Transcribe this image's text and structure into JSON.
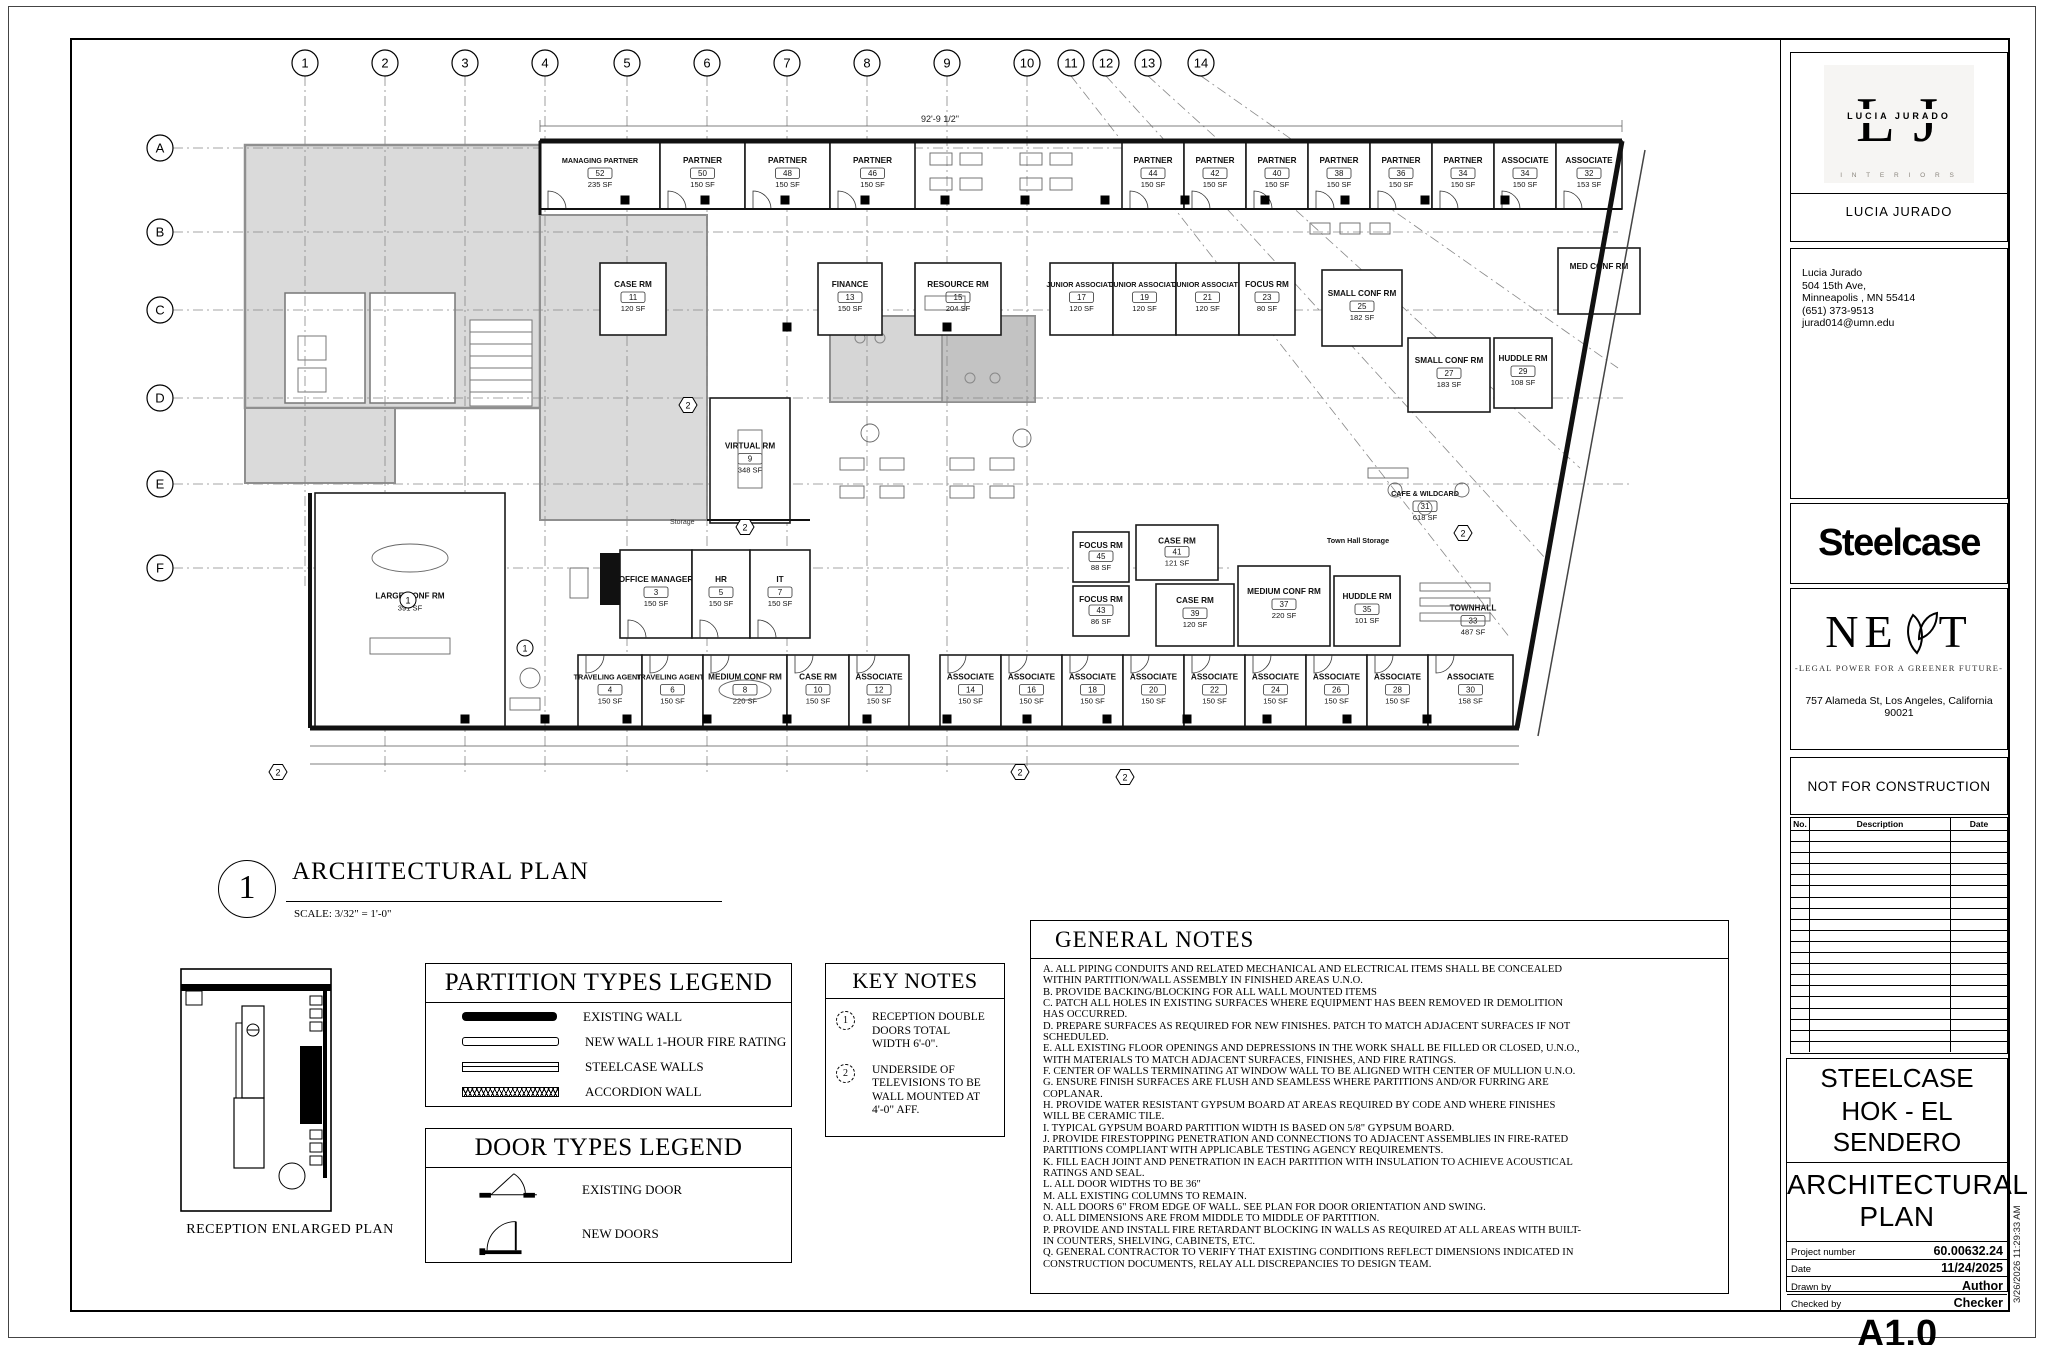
{
  "sheet": {
    "view": {
      "number": "1",
      "title": "ARCHITECTURAL PLAN",
      "scale": "SCALE: 3/32\" = 1'-0\""
    },
    "reception_plan_label": "RECEPTION ENLARGED PLAN",
    "top_dimension": "92'-9 1/2\"",
    "storage_label": "Storage",
    "print_timestamp": "3/26/2026 11:29:33 AM"
  },
  "grid": {
    "columns": [
      {
        "label": "1",
        "x": 235,
        "len": 552
      },
      {
        "label": "2",
        "x": 315,
        "len": 735
      },
      {
        "label": "3",
        "x": 395,
        "len": 735
      },
      {
        "label": "4",
        "x": 475,
        "len": 735
      },
      {
        "label": "5",
        "x": 557,
        "len": 735
      },
      {
        "label": "6",
        "x": 637,
        "len": 735
      },
      {
        "label": "7",
        "x": 717,
        "len": 735
      },
      {
        "label": "8",
        "x": 797,
        "len": 735
      },
      {
        "label": "9",
        "x": 877,
        "len": 735
      },
      {
        "label": "10",
        "x": 957,
        "len": 735
      },
      {
        "label": "11",
        "x": 1001,
        "x2": 1440,
        "y2": 600
      },
      {
        "label": "12",
        "x": 1036,
        "x2": 1475,
        "y2": 520
      },
      {
        "label": "13",
        "x": 1078,
        "x2": 1510,
        "y2": 430
      },
      {
        "label": "14",
        "x": 1131,
        "x2": 1548,
        "y2": 330
      }
    ],
    "rows": [
      {
        "label": "A",
        "y": 110,
        "x2": 1545
      },
      {
        "label": "B",
        "y": 194,
        "x2": 1548
      },
      {
        "label": "C",
        "y": 272,
        "x2": 1552
      },
      {
        "label": "D",
        "y": 360,
        "x2": 1556
      },
      {
        "label": "E",
        "y": 446,
        "x2": 1560
      },
      {
        "label": "F",
        "y": 530,
        "x2": 1160
      }
    ]
  },
  "rooms": [
    {
      "name": "MANAGING PARTNER",
      "num": "52",
      "area": "235 SF",
      "x": 470,
      "y": 103,
      "w": 120,
      "h": 68,
      "door": "b"
    },
    {
      "name": "PARTNER",
      "num": "50",
      "area": "150 SF",
      "x": 590,
      "y": 103,
      "w": 85,
      "h": 68,
      "door": "b"
    },
    {
      "name": "PARTNER",
      "num": "48",
      "area": "150 SF",
      "x": 675,
      "y": 103,
      "w": 85,
      "h": 68,
      "door": "b"
    },
    {
      "name": "PARTNER",
      "num": "46",
      "area": "150 SF",
      "x": 760,
      "y": 103,
      "w": 85,
      "h": 68,
      "door": "b"
    },
    {
      "name": "PARTNER",
      "num": "44",
      "area": "150 SF",
      "x": 1052,
      "y": 103,
      "w": 62,
      "h": 68,
      "door": "b"
    },
    {
      "name": "PARTNER",
      "num": "42",
      "area": "150 SF",
      "x": 1114,
      "y": 103,
      "w": 62,
      "h": 68,
      "door": "b"
    },
    {
      "name": "PARTNER",
      "num": "40",
      "area": "150 SF",
      "x": 1176,
      "y": 103,
      "w": 62,
      "h": 68,
      "door": "b"
    },
    {
      "name": "PARTNER",
      "num": "38",
      "area": "150 SF",
      "x": 1238,
      "y": 103,
      "w": 62,
      "h": 68,
      "door": "b"
    },
    {
      "name": "PARTNER",
      "num": "36",
      "area": "150 SF",
      "x": 1300,
      "y": 103,
      "w": 62,
      "h": 68,
      "door": "b"
    },
    {
      "name": "PARTNER",
      "num": "34",
      "area": "150 SF",
      "x": 1362,
      "y": 103,
      "w": 62,
      "h": 68,
      "door": "b"
    },
    {
      "name": "ASSOCIATE",
      "num": "34",
      "area": "150 SF",
      "x": 1424,
      "y": 103,
      "w": 62,
      "h": 68,
      "door": "b"
    },
    {
      "name": "ASSOCIATE",
      "num": "32",
      "area": "153 SF",
      "x": 1486,
      "y": 103,
      "w": 66,
      "h": 68,
      "door": "b"
    },
    {
      "name": "CASE RM",
      "num": "11",
      "area": "120 SF",
      "x": 530,
      "y": 225,
      "w": 66,
      "h": 72
    },
    {
      "name": "FINANCE",
      "num": "13",
      "area": "150 SF",
      "x": 748,
      "y": 225,
      "w": 64,
      "h": 72
    },
    {
      "name": "RESOURCE RM",
      "num": "15",
      "area": "204 SF",
      "x": 845,
      "y": 225,
      "w": 86,
      "h": 72
    },
    {
      "name": "JUNIOR ASSOCIATE",
      "num": "17",
      "area": "120 SF",
      "x": 980,
      "y": 225,
      "w": 63,
      "h": 72
    },
    {
      "name": "JUNIOR ASSOCIATE",
      "num": "19",
      "area": "120 SF",
      "x": 1043,
      "y": 225,
      "w": 63,
      "h": 72
    },
    {
      "name": "JUNIOR ASSOCIATE",
      "num": "21",
      "area": "120 SF",
      "x": 1106,
      "y": 225,
      "w": 63,
      "h": 72
    },
    {
      "name": "FOCUS RM",
      "num": "23",
      "area": "80 SF",
      "x": 1169,
      "y": 225,
      "w": 56,
      "h": 72
    },
    {
      "name": "SMALL CONF RM",
      "num": "25",
      "area": "182 SF",
      "x": 1252,
      "y": 232,
      "w": 80,
      "h": 76
    },
    {
      "name": "SMALL CONF RM",
      "num": "27",
      "area": "183 SF",
      "x": 1338,
      "y": 300,
      "w": 82,
      "h": 74
    },
    {
      "name": "HUDDLE RM",
      "num": "29",
      "area": "108 SF",
      "x": 1424,
      "y": 300,
      "w": 58,
      "h": 70
    },
    {
      "name": "MED CONF RM",
      "num": "",
      "area": "",
      "x": 1488,
      "y": 210,
      "w": 82,
      "h": 66
    },
    {
      "name": "VIRTUAL RM",
      "num": "9",
      "area": "348 SF",
      "x": 640,
      "y": 360,
      "w": 80,
      "h": 125
    },
    {
      "name": "FOCUS RM",
      "num": "45",
      "area": "88 SF",
      "x": 1003,
      "y": 494,
      "w": 56,
      "h": 50
    },
    {
      "name": "FOCUS RM",
      "num": "43",
      "area": "86 SF",
      "x": 1003,
      "y": 548,
      "w": 56,
      "h": 50
    },
    {
      "name": "CASE RM",
      "num": "41",
      "area": "121 SF",
      "x": 1066,
      "y": 487,
      "w": 82,
      "h": 55
    },
    {
      "name": "CASE RM",
      "num": "39",
      "area": "120 SF",
      "x": 1086,
      "y": 546,
      "w": 78,
      "h": 62
    },
    {
      "name": "MEDIUM CONF RM",
      "num": "37",
      "area": "220 SF",
      "x": 1168,
      "y": 528,
      "w": 92,
      "h": 80
    },
    {
      "name": "HUDDLE RM",
      "num": "35",
      "area": "101 SF",
      "x": 1264,
      "y": 538,
      "w": 66,
      "h": 70
    },
    {
      "name": "Town Hall Storage",
      "num": "",
      "area": "",
      "x": 1238,
      "y": 498,
      "w": 100,
      "h": 14,
      "labelOnly": true
    },
    {
      "name": "TOWNHALL",
      "num": "33",
      "area": "487 SF",
      "x": 1334,
      "y": 525,
      "w": 138,
      "h": 95,
      "labelOnly": true
    },
    {
      "name": "CAFE & WILDCARD",
      "num": "31",
      "area": "618 SF",
      "x": 1290,
      "y": 418,
      "w": 130,
      "h": 80,
      "labelOnly": true
    },
    {
      "name": "OFFICE MANAGER",
      "num": "3",
      "area": "150 SF",
      "x": 550,
      "y": 512,
      "w": 72,
      "h": 88,
      "door": "b"
    },
    {
      "name": "HR",
      "num": "5",
      "area": "150 SF",
      "x": 622,
      "y": 512,
      "w": 58,
      "h": 88,
      "door": "b"
    },
    {
      "name": "IT",
      "num": "7",
      "area": "150 SF",
      "x": 680,
      "y": 512,
      "w": 60,
      "h": 88,
      "door": "b"
    },
    {
      "name": "LARGE CONF RM",
      "num": "",
      "area": "391 SF",
      "x": 245,
      "y": 455,
      "w": 190,
      "h": 235
    },
    {
      "name": "TRAVELING AGENTS",
      "num": "4",
      "area": "150 SF",
      "x": 508,
      "y": 617,
      "w": 64,
      "h": 73,
      "door": "t"
    },
    {
      "name": "TRAVELING AGENTS",
      "num": "6",
      "area": "150 SF",
      "x": 572,
      "y": 617,
      "w": 61,
      "h": 73,
      "door": "t"
    },
    {
      "name": "MEDIUM CONF RM",
      "num": "8",
      "area": "220 SF",
      "x": 633,
      "y": 617,
      "w": 84,
      "h": 73,
      "door": "t"
    },
    {
      "name": "CASE RM",
      "num": "10",
      "area": "150 SF",
      "x": 717,
      "y": 617,
      "w": 62,
      "h": 73,
      "door": "t"
    },
    {
      "name": "ASSOCIATE",
      "num": "12",
      "area": "150 SF",
      "x": 779,
      "y": 617,
      "w": 60,
      "h": 73,
      "door": "t"
    },
    {
      "name": "ASSOCIATE",
      "num": "14",
      "area": "150 SF",
      "x": 870,
      "y": 617,
      "w": 61,
      "h": 73,
      "door": "t"
    },
    {
      "name": "ASSOCIATE",
      "num": "16",
      "area": "150 SF",
      "x": 931,
      "y": 617,
      "w": 61,
      "h": 73,
      "door": "t"
    },
    {
      "name": "ASSOCIATE",
      "num": "18",
      "area": "150 SF",
      "x": 992,
      "y": 617,
      "w": 61,
      "h": 73,
      "door": "t"
    },
    {
      "name": "ASSOCIATE",
      "num": "20",
      "area": "150 SF",
      "x": 1053,
      "y": 617,
      "w": 61,
      "h": 73,
      "door": "t"
    },
    {
      "name": "ASSOCIATE",
      "num": "22",
      "area": "150 SF",
      "x": 1114,
      "y": 617,
      "w": 61,
      "h": 73,
      "door": "t"
    },
    {
      "name": "ASSOCIATE",
      "num": "24",
      "area": "150 SF",
      "x": 1175,
      "y": 617,
      "w": 61,
      "h": 73,
      "door": "t"
    },
    {
      "name": "ASSOCIATE",
      "num": "26",
      "area": "150 SF",
      "x": 1236,
      "y": 617,
      "w": 61,
      "h": 73,
      "door": "t"
    },
    {
      "name": "ASSOCIATE",
      "num": "28",
      "area": "150 SF",
      "x": 1297,
      "y": 617,
      "w": 61,
      "h": 73,
      "door": "t"
    },
    {
      "name": "ASSOCIATE",
      "num": "30",
      "area": "158 SF",
      "x": 1358,
      "y": 617,
      "w": 85,
      "h": 73,
      "door": "t"
    }
  ],
  "key_markers": [
    {
      "num": "1",
      "shape": "circle",
      "x": 455,
      "y": 610
    },
    {
      "num": "1",
      "shape": "circle",
      "x": 338,
      "y": 562
    },
    {
      "num": "2",
      "shape": "hex",
      "x": 618,
      "y": 367
    },
    {
      "num": "2",
      "shape": "hex",
      "x": 675,
      "y": 489
    },
    {
      "num": "2",
      "shape": "hex",
      "x": 1393,
      "y": 495
    },
    {
      "num": "2",
      "shape": "hex",
      "x": 208,
      "y": 734
    },
    {
      "num": "2",
      "shape": "hex",
      "x": 950,
      "y": 734
    },
    {
      "num": "2",
      "shape": "hex",
      "x": 1055,
      "y": 739
    }
  ],
  "columns_struct": {
    "size": 9,
    "rows": [
      {
        "y": 162,
        "x": [
          555,
          635,
          715,
          795,
          875,
          955,
          1035,
          1115,
          1195,
          1275,
          1355,
          1435
        ]
      },
      {
        "y": 681,
        "x": [
          395,
          475,
          557,
          637,
          717,
          797,
          877,
          957,
          1037,
          1117,
          1197,
          1277,
          1357
        ]
      },
      {
        "y": 289,
        "x": [
          717,
          877
        ]
      }
    ]
  },
  "partition_legend": {
    "title": "PARTITION TYPES LEGEND",
    "items": [
      {
        "type": "existing",
        "label": "EXISTING WALL"
      },
      {
        "type": "new1hr",
        "label": "NEW WALL 1-HOUR FIRE RATING"
      },
      {
        "type": "steelcase",
        "label": "STEELCASE WALLS"
      },
      {
        "type": "accordion",
        "label": "ACCORDION WALL"
      }
    ]
  },
  "door_legend": {
    "title": "DOOR TYPES LEGEND",
    "items": [
      {
        "type": "existing",
        "label": "EXISTING DOOR"
      },
      {
        "type": "new",
        "label": "NEW DOORS"
      }
    ]
  },
  "key_notes": {
    "title": "KEY NOTES",
    "items": [
      {
        "num": "1",
        "text": "RECEPTION DOUBLE DOORS TOTAL WIDTH 6'-0\"."
      },
      {
        "num": "2",
        "text": "UNDERSIDE OF TELEVISIONS TO BE WALL MOUNTED AT 4'-0\" AFF."
      }
    ]
  },
  "general_notes": {
    "title": "GENERAL NOTES",
    "notes": [
      "A. ALL PIPING CONDUITS AND RELATED MECHANICAL AND ELECTRICAL ITEMS SHALL BE CONCEALED WITHIN PARTITION/WALL ASSEMBLY IN FINISHED AREAS U.N.O.",
      "B. PROVIDE BACKING/BLOCKING FOR ALL WALL MOUNTED ITEMS",
      "C. PATCH ALL HOLES IN EXISTING SURFACES WHERE EQUIPMENT HAS BEEN REMOVED IR DEMOLITION HAS OCCURRED.",
      "D. PREPARE SURFACES AS REQUIRED FOR NEW FINISHES. PATCH TO MATCH ADJACENT SURFACES IF NOT SCHEDULED.",
      "E. ALL EXISTING FLOOR OPENINGS AND DEPRESSIONS IN THE WORK SHALL BE FILLED OR CLOSED, U.N.O., WITH MATERIALS TO MATCH ADJACENT SURFACES, FINISHES, AND FIRE RATINGS.",
      "F. CENTER OF WALLS TERMINATING AT WINDOW WALL TO BE ALIGNED WITH CENTER OF MULLION U.N.O.",
      "G. ENSURE FINISH SURFACES ARE FLUSH AND SEAMLESS WHERE PARTITIONS AND/OR FURRING ARE COPLANAR.",
      "H. PROVIDE  WATER RESISTANT GYPSUM BOARD AT AREAS REQUIRED BY CODE AND WHERE FINISHES WILL BE CERAMIC TILE.",
      "I. TYPICAL GYPSUM BOARD PARTITION WIDTH IS BASED ON 5/8\" GYPSUM BOARD.",
      "J. PROVIDE FIRESTOPPING PENETRATION AND CONNECTIONS TO ADJACENT ASSEMBLIES IN FIRE-RATED PARTITIONS COMPLIANT WITH APPLICABLE TESTING AGENCY REQUIREMENTS.",
      "K. FILL EACH JOINT AND PENETRATION IN EACH PARTITION WITH INSULATION TO ACHIEVE ACOUSTICAL RATINGS AND SEAL.",
      "L. ALL DOOR WIDTHS TO BE 36\"",
      "M. ALL EXISTING COLUMNS TO REMAIN.",
      "N. ALL DOORS 6\" FROM EDGE OF WALL. SEE PLAN FOR DOOR ORIENTATION AND SWING.",
      "O. ALL DIMENSIONS ARE FROM MIDDLE TO MIDDLE OF PARTITION.",
      "P. PROVIDE AND INSTALL FIRE RETARDANT BLOCKING IN WALLS AS REQUIRED AT ALL AREAS WITH BUILT-IN COUNTERS, SHELVING, CABINETS, ETC.",
      "Q. GENERAL CONTRACTOR TO VERIFY THAT EXISTING CONDITIONS REFLECT DIMENSIONS INDICATED IN CONSTRUCTION DOCUMENTS, RELAY ALL DISCREPANCIES TO DESIGN TEAM."
    ]
  },
  "title_block": {
    "monogram": {
      "left": "L",
      "right": "J",
      "name": "LUCIA JURADO",
      "sub": "I N T E R I O R S"
    },
    "firm_name": "LUCIA JURADO",
    "contact": [
      "Lucia Jurado",
      "504 15th Ave,",
      "Minneapolis , MN 55414",
      "(651) 373-9513",
      "jurad014@umn.edu"
    ],
    "client_wordmark": "Steelcase",
    "next": {
      "left": "NE",
      "right": "T",
      "tagline": "-LEGAL POWER FOR A GREENER FUTURE-",
      "address": "757 Alameda St, Los Angeles, California 90021"
    },
    "status": "NOT FOR CONSTRUCTION",
    "revisions": {
      "headers": [
        "No.",
        "Description",
        "Date"
      ],
      "empty_rows": 20
    },
    "project_line1": "STEELCASE",
    "project_line2": "HOK - EL SENDERO",
    "sheet_title": "ARCHITECTURAL PLAN",
    "fields": [
      {
        "label": "Project number",
        "value": "60.00632.24"
      },
      {
        "label": "Date",
        "value": "11/24/2025"
      },
      {
        "label": "Drawn by",
        "value": "Author"
      },
      {
        "label": "Checked by",
        "value": "Checker"
      }
    ],
    "sheet_number": "A1.0",
    "scale_label": "Scale",
    "scale_value": "As indicated"
  }
}
